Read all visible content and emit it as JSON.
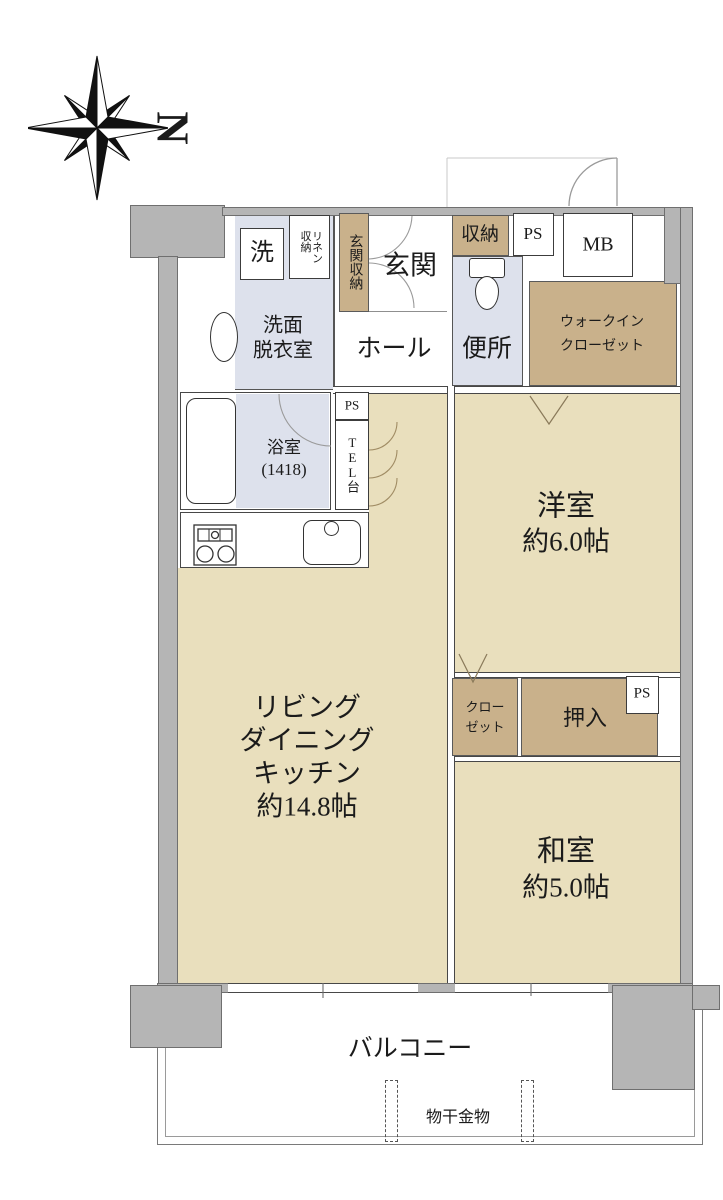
{
  "compass": {
    "north_label": "N"
  },
  "colors": {
    "wall_gray": "#b5b5b5",
    "floor_tan": "#e9dfbd",
    "wet_area_blue": "#dde1ec",
    "storage_brown": "#c9b18b",
    "line_dark": "#3c3c3c"
  },
  "rooms": {
    "washroom": {
      "line1": "洗面",
      "line2": "脱衣室"
    },
    "washer": {
      "label": "洗"
    },
    "linen": {
      "label": "リネン\n収納"
    },
    "entrance_storage": {
      "label": "玄関収納"
    },
    "entrance": {
      "label": "玄関"
    },
    "hall": {
      "label": "ホール"
    },
    "storage": {
      "label": "収納"
    },
    "ps_top": {
      "label": "PS"
    },
    "mb": {
      "label": "MB"
    },
    "toilet": {
      "label": "便所"
    },
    "walk_in_closet": {
      "line1": "ウォークイン",
      "line2": "クローゼット"
    },
    "bath": {
      "line1": "浴室",
      "line2": "(1418)"
    },
    "ps_mid": {
      "label": "PS"
    },
    "tel": {
      "label": "TEL台"
    },
    "ldk": {
      "line1": "リビング",
      "line2": "ダイニング",
      "line3": "キッチン",
      "line4": "約14.8帖"
    },
    "western_room": {
      "line1": "洋室",
      "line2": "約6.0帖"
    },
    "closet": {
      "line1": "クロー",
      "line2": "ゼット"
    },
    "oshiire": {
      "label": "押入"
    },
    "ps_east": {
      "label": "PS"
    },
    "japanese_room": {
      "line1": "和室",
      "line2": "約5.0帖"
    },
    "balcony": {
      "label": "バルコニー"
    },
    "drying_hardware": {
      "label": "物干金物"
    }
  }
}
